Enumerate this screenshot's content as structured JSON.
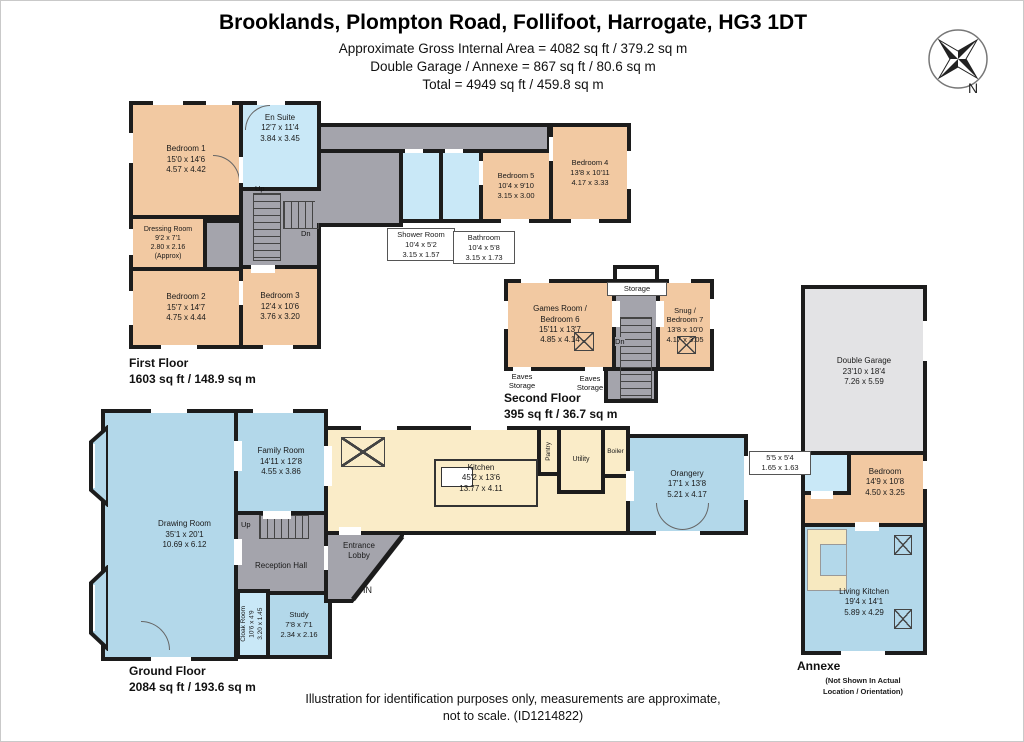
{
  "header": {
    "title": "Brooklands, Plompton Road, Follifoot, Harrogate, HG3 1DT",
    "area_line1": "Approximate Gross Internal Area = 4082 sq ft / 379.2 sq m",
    "area_line2": "Double Garage / Annexe = 867 sq ft / 80.6 sq m",
    "area_line3": "Total = 4949 sq ft / 459.8 sq m"
  },
  "compass": {
    "north": "N"
  },
  "floors": {
    "first": {
      "name": "First Floor",
      "area": "1603 sq ft / 148.9 sq m"
    },
    "second": {
      "name": "Second Floor",
      "area": "395 sq ft / 36.7 sq m"
    },
    "ground": {
      "name": "Ground Floor",
      "area": "2084 sq ft / 193.6 sq m"
    },
    "annexe": {
      "name": "Annexe",
      "note_line1": "(Not Shown In Actual",
      "note_line2": "Location / Orientation)"
    }
  },
  "stairs": {
    "up": "Up",
    "down": "Dn"
  },
  "entrance": {
    "in_label": "IN"
  },
  "rooms": {
    "bedroom1": {
      "name": "Bedroom 1",
      "imperial": "15'0 x 14'6",
      "metric": "4.57 x 4.42"
    },
    "en_suite": {
      "name": "En Suite",
      "imperial": "12'7 x 11'4",
      "metric": "3.84 x 3.45"
    },
    "dressing_room": {
      "name": "Dressing Room",
      "imperial": "9'2 x 7'1",
      "metric": "2.80 x 2.16",
      "approx": "(Approx)"
    },
    "bedroom2": {
      "name": "Bedroom 2",
      "imperial": "15'7 x 14'7",
      "metric": "4.75 x 4.44"
    },
    "bedroom3": {
      "name": "Bedroom 3",
      "imperial": "12'4 x 10'6",
      "metric": "3.76 x 3.20"
    },
    "shower_room": {
      "name": "Shower Room",
      "imperial": "10'4 x 5'2",
      "metric": "3.15 x 1.57"
    },
    "bathroom": {
      "name": "Bathroom",
      "imperial": "10'4 x 5'8",
      "metric": "3.15 x 1.73"
    },
    "bedroom5": {
      "name": "Bedroom 5",
      "imperial": "10'4 x 9'10",
      "metric": "3.15 x 3.00"
    },
    "bedroom4": {
      "name": "Bedroom 4",
      "imperial": "13'8 x 10'11",
      "metric": "4.17 x 3.33"
    },
    "storage": {
      "name": "Storage"
    },
    "games_room": {
      "name_line1": "Games Room /",
      "name_line2": "Bedroom 6",
      "imperial": "15'11 x 13'7",
      "metric": "4.85 x 4.14"
    },
    "snug": {
      "name_line1": "Snug /",
      "name_line2": "Bedroom 7",
      "imperial": "13'8 x 10'0",
      "metric": "4.17 x 3.05"
    },
    "eaves": {
      "line1": "Eaves",
      "line2": "Storage"
    },
    "double_garage": {
      "name": "Double Garage",
      "imperial": "23'10 x 18'4",
      "metric": "7.26 x 5.59"
    },
    "annexe_shower": {
      "imperial": "5'5 x 5'4",
      "metric": "1.65 x 1.63"
    },
    "annexe_bedroom": {
      "name": "Bedroom",
      "imperial": "14'9 x 10'8",
      "metric": "4.50 x 3.25"
    },
    "living_kitchen": {
      "name": "Living Kitchen",
      "imperial": "19'4 x 14'1",
      "metric": "5.89 x 4.29"
    },
    "drawing_room": {
      "name": "Drawing Room",
      "imperial": "35'1 x 20'1",
      "metric": "10.69 x 6.12"
    },
    "family_room": {
      "name": "Family Room",
      "imperial": "14'11 x 12'8",
      "metric": "4.55 x 3.86"
    },
    "reception_hall": {
      "name": "Reception Hall"
    },
    "cloak_room": {
      "name": "Cloak Room",
      "imperial": "10'6 x 4'9",
      "metric": "3.20 x 1.45"
    },
    "study": {
      "name": "Study",
      "imperial": "7'8 x 7'1",
      "metric": "2.34 x 2.16"
    },
    "entrance_lobby": {
      "name_line1": "Entrance",
      "name_line2": "Lobby"
    },
    "kitchen": {
      "name": "Kitchen",
      "imperial": "45'2 x 13'6",
      "metric": "13.77 x 4.11"
    },
    "pantry": {
      "name": "Pantry"
    },
    "utility": {
      "name": "Utility"
    },
    "boiler": {
      "name": "Boiler"
    },
    "orangery": {
      "name": "Orangery",
      "imperial": "17'1 x 13'8",
      "metric": "5.21 x 4.17"
    }
  },
  "footer": {
    "line1": "Illustration for identification purposes only, measurements are approximate,",
    "line2": "not to scale. (ID1214822)"
  },
  "colors": {
    "bedroom": "#f2c9a2",
    "bathroom": "#c9e8f7",
    "living": "#b3d8ea",
    "hall": "#a4a4ac",
    "kitchen": "#faecc8",
    "garage": "#e3e3e5",
    "wall": "#1c1c1c"
  }
}
